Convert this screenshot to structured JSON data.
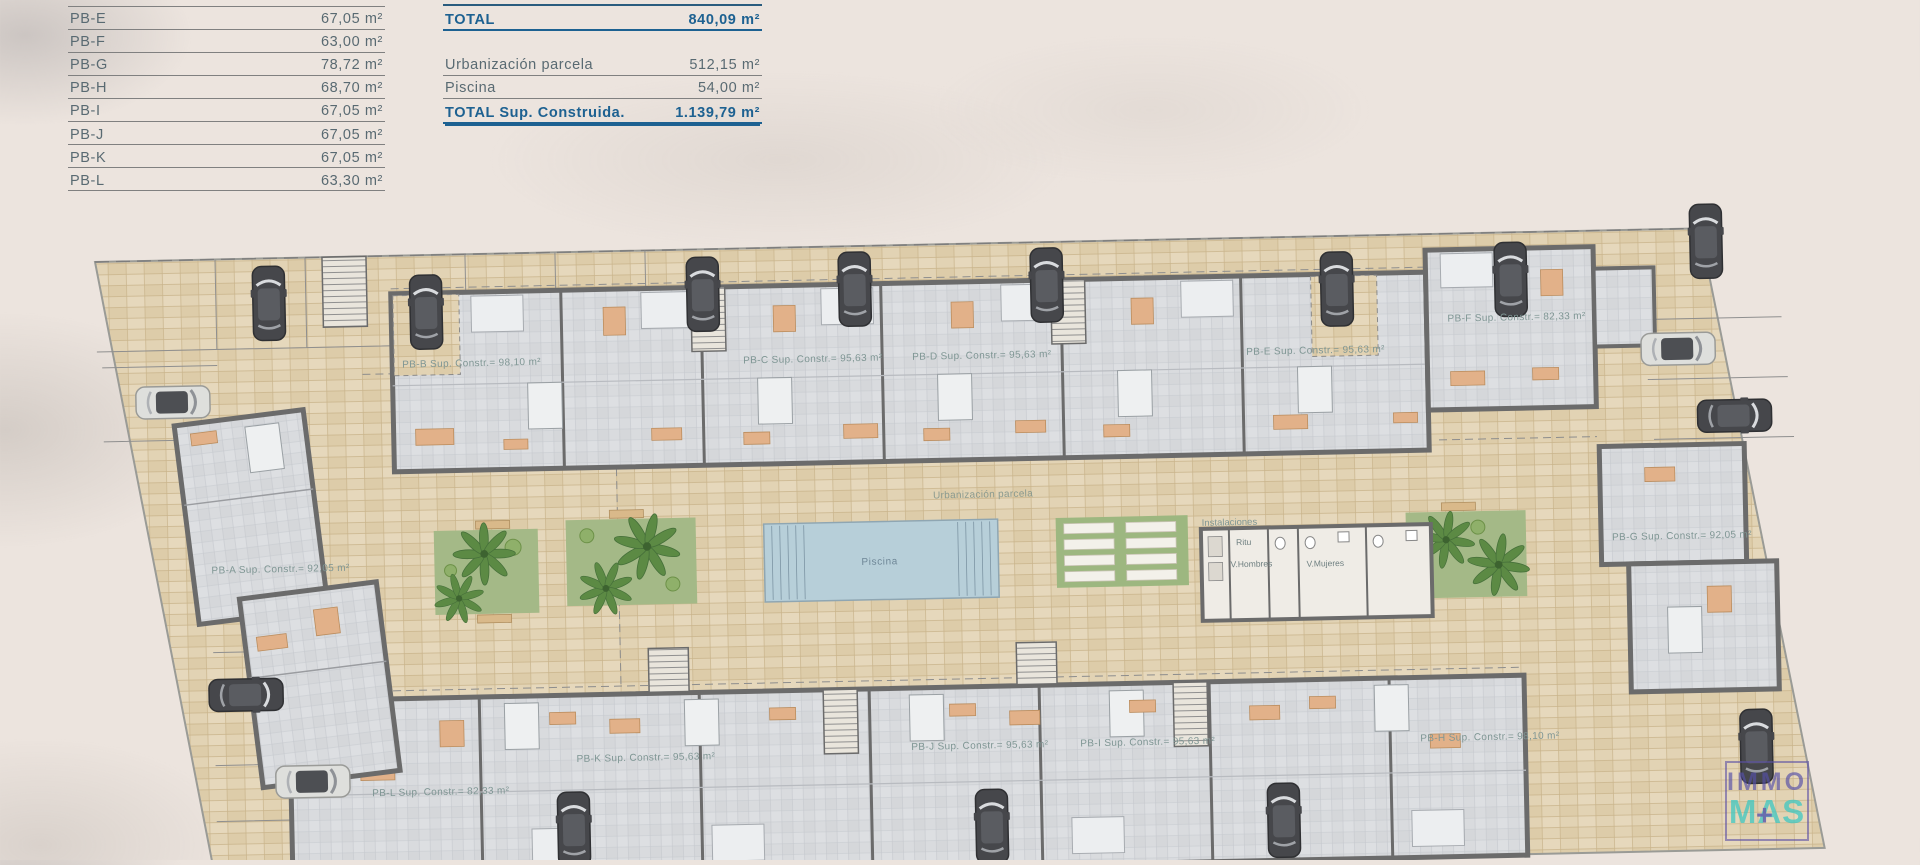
{
  "page": {
    "background": "#ece4de"
  },
  "colors": {
    "accent_blue": "#1d6191",
    "table_gray": "#596a72",
    "plan_label": "#7f9694",
    "paver": "#e2d3b4",
    "pool": "#b7cfd9",
    "garden": "#a4b987",
    "logo_purple": "#5450a8",
    "logo_teal": "#3ec7c2"
  },
  "area_table": {
    "rows": [
      {
        "label": "PB-E",
        "value": "67,05 m²"
      },
      {
        "label": "PB-F",
        "value": "63,00 m²"
      },
      {
        "label": "PB-G",
        "value": "78,72 m²"
      },
      {
        "label": "PB-H",
        "value": "68,70 m²"
      },
      {
        "label": "PB-I",
        "value": "67,05 m²"
      },
      {
        "label": "PB-J",
        "value": "67,05 m²"
      },
      {
        "label": "PB-K",
        "value": "67,05 m²"
      },
      {
        "label": "PB-L",
        "value": "63,30 m²"
      }
    ]
  },
  "totals_table": {
    "total": {
      "label": "TOTAL",
      "value": "840,09 m²"
    },
    "rows": [
      {
        "label": "Urbanización parcela",
        "value": "512,15 m²"
      },
      {
        "label": "Piscina",
        "value": "54,00 m²"
      }
    ],
    "grand": {
      "label": "TOTAL Sup. Construida.",
      "value": "1.139,79 m²"
    }
  },
  "plan": {
    "units": [
      {
        "label": "PB-A Sup. Constr.= 92,05 m²"
      },
      {
        "label": "PB-B Sup. Constr.= 98,10 m²"
      },
      {
        "label": "PB-C Sup. Constr.= 95,63 m²"
      },
      {
        "label": "PB-D Sup. Constr.= 95,63 m²"
      },
      {
        "label": "PB-E Sup. Constr.= 95,63 m²"
      },
      {
        "label": "PB-F Sup. Constr.= 82,33 m²"
      },
      {
        "label": "PB-G Sup. Constr.= 92,05 m²"
      },
      {
        "label": "PB-H Sup. Constr.= 98,10 m²"
      },
      {
        "label": "PB-I Sup. Constr.= 95,63 m²"
      },
      {
        "label": "PB-J Sup. Constr.= 95,63 m²"
      },
      {
        "label": "PB-K Sup. Constr.= 95,63 m²"
      },
      {
        "label": "PB-L Sup. Constr.= 82,33 m²"
      }
    ],
    "amenities": {
      "urbanizacion": "Urbanización parcela",
      "piscina": "Piscina",
      "instalaciones": "Instalaciones"
    },
    "rooms": [
      "Ritu",
      "V.Hombres",
      "V.Mujeres"
    ]
  },
  "logo": {
    "immo": "IMMO",
    "mas": "MAS",
    "plus": "+"
  }
}
